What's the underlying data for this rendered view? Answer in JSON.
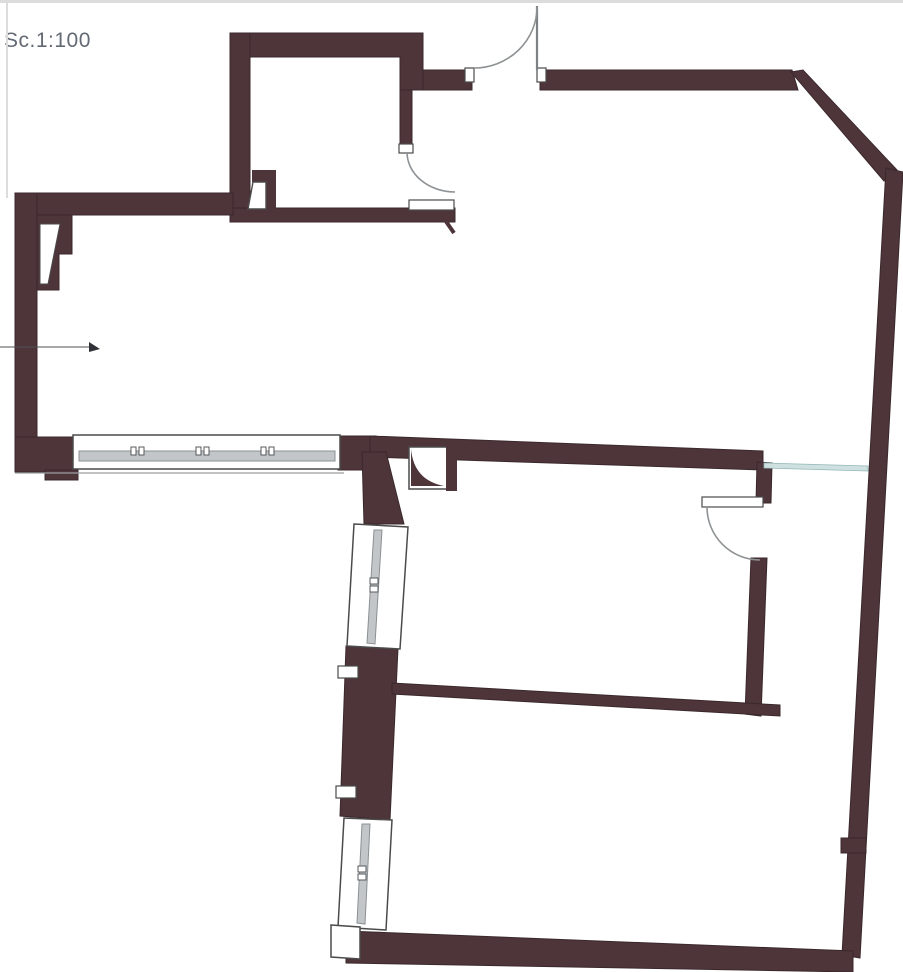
{
  "page": {
    "scale_label": "Sc.1:100"
  },
  "plan": {
    "type": "architectural-floor-plan",
    "rooms": [
      "top-left-room",
      "left-room",
      "open-living-area",
      "bottom-room",
      "right-room"
    ],
    "features": [
      "entry-door-top",
      "interior-door-top-left-room",
      "interior-door-right-room",
      "window-band-left",
      "window-column-left-slanted",
      "diagonal-corner-top-right",
      "leader-arrow-left",
      "junction-pillar-with-fillet",
      "teal-beam-opening"
    ]
  },
  "colors": {
    "wall": "#4e353a",
    "wall_edge": "#3a282c",
    "window_frame_stroke": "#4b4b4b",
    "glazing_fill": "#c2c6c8",
    "glazing_stroke": "#8b9093",
    "door_arc": "#8f9294",
    "beam_teal": "#cfe0e0",
    "beam_teal_stroke": "#93b7b7",
    "label_text": "#636a74",
    "page_edge": "#dcdcdc",
    "background": "#ffffff"
  }
}
